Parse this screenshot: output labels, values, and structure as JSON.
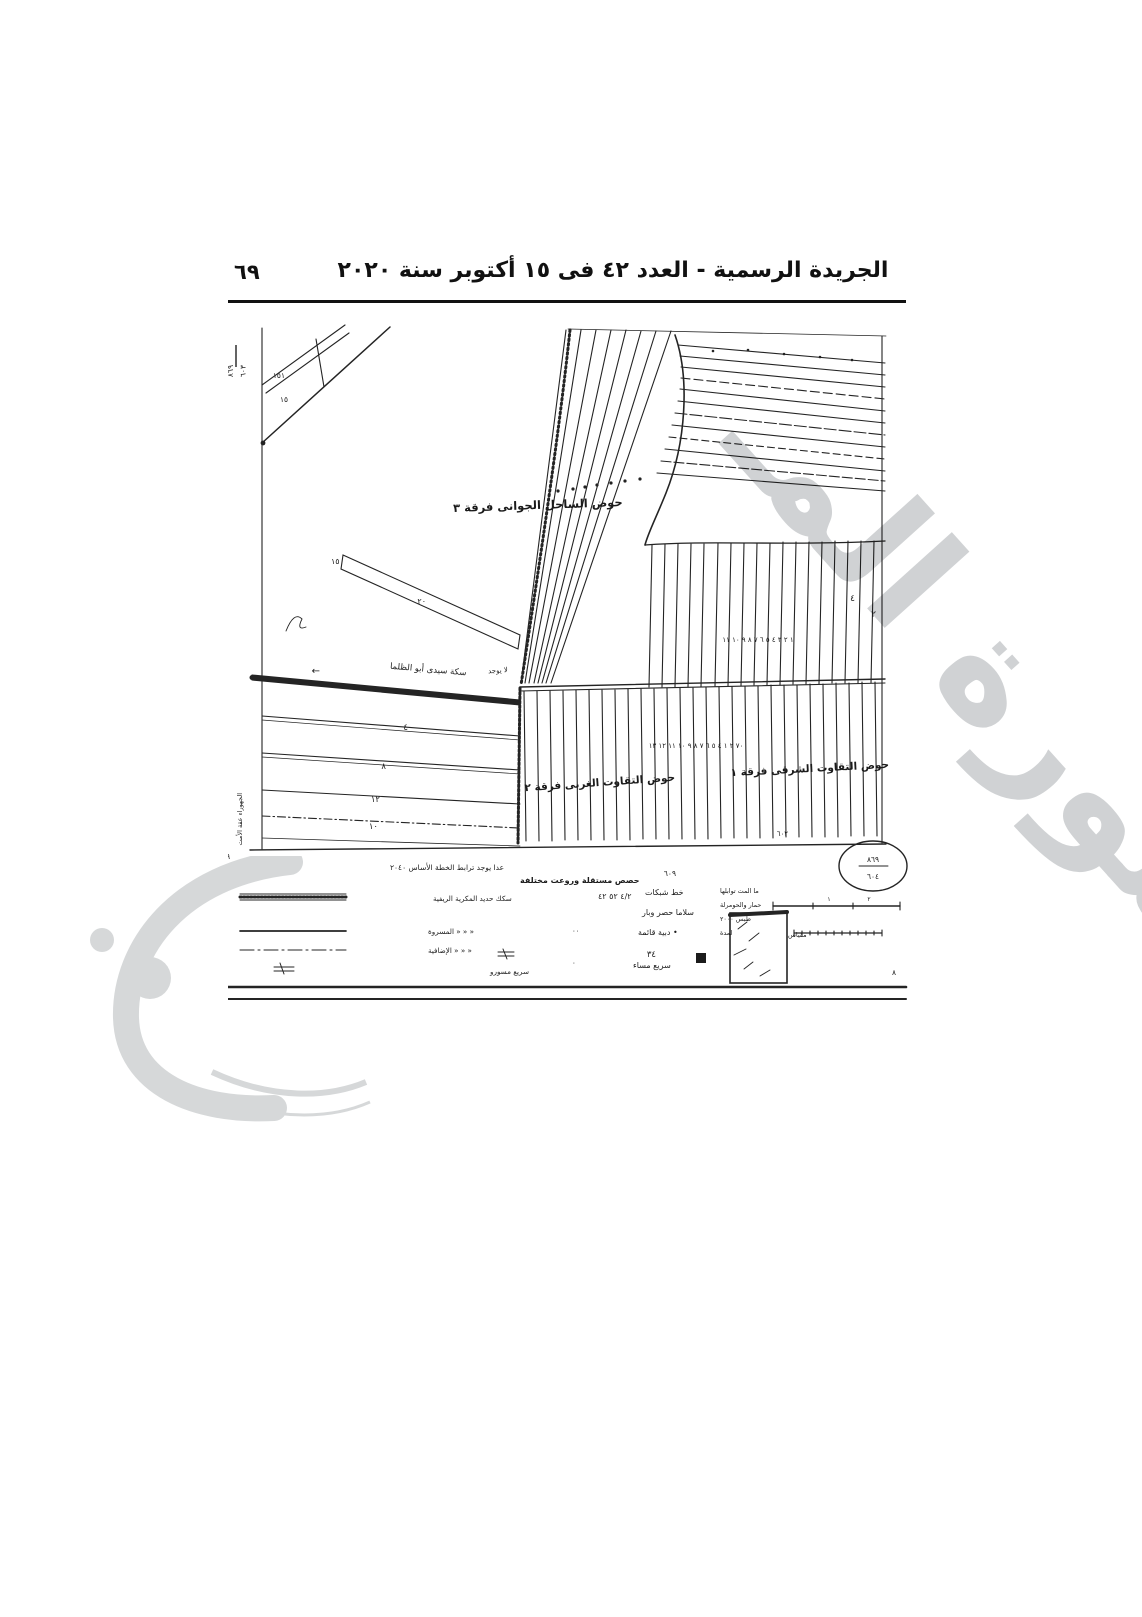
{
  "page": {
    "number": "٦٩",
    "header": "الجريدة الرسمية - العدد ٤٢ فى ١٥ أكتوبر سنة ٢٠٢٠"
  },
  "map": {
    "fraction_top": {
      "top": "٨٦٩",
      "bottom": "٦٠٣"
    },
    "corner_869": "٨٦٩",
    "num_609": "٦٠٩",
    "oval": {
      "top": "٨٦٩",
      "bottom": "٦٠٤"
    },
    "labels": {
      "hawd_top": "حوض الساحل الجوانى فرقة ٣",
      "hawd_west": "حوض التقاوت الغربى فرقة ٢",
      "hawd_east": "حوض التقاوت الشرقى فرقة ١",
      "railway": "سكة سيدى أبو الظلما",
      "arrow": "←",
      "no_exist": "لا يوجد",
      "left_edge": "الجهوراء عقة الأمت",
      "strip_left": "١٥",
      "strip_mid": "٢٠",
      "num_151": "١٥١",
      "num_15": "١٥",
      "bands": [
        "٤",
        "٨",
        "١٢",
        "١٠"
      ],
      "mid_numbers": "١ ٢ ٣ ٤ ٥ ٦ ٧ ٨ ٩ ١٠ ١١",
      "bottom_numbers": "٧٠ ٢ ١ ٤ ٥ ٦ ٧ ٨ ٩ ١٠ ١١ ١٢ ١٣",
      "num_4": "٤",
      "num_2": "٢",
      "num_602": "٦٠٢"
    }
  },
  "legend": {
    "note": "عدا يوجد ترابط الخطة الأساس ٢٠٤٠",
    "subnote": "حصص مستقلة وروعت مختلفة",
    "left": [
      {
        "label": "سكك حديد المكرية الريفية",
        "extra": "٤/٢ ٥٢ ٤٢"
      },
      {
        "label": "« « « المسروة",
        "extra": "٠٠"
      },
      {
        "label": "« « « الإضافية",
        "extra": "٠"
      },
      {
        "label": "سريع مسورو",
        "extra": ""
      }
    ],
    "mid": [
      "خط شبكات",
      "سلاما حصر وبار",
      "• دبية قائمة",
      "سريع مساء"
    ],
    "mid_num": "٣٤",
    "right_lines": [
      "ما المت توابلها",
      "حمار والحومرلة",
      "طبس ٢٠٠٠",
      "لمدة"
    ],
    "scale_label": "مقياس",
    "tick_1": "١",
    "tick_2": "٢",
    "num_8": "٨"
  },
  "watermark": {
    "text": "صورة المـ"
  }
}
